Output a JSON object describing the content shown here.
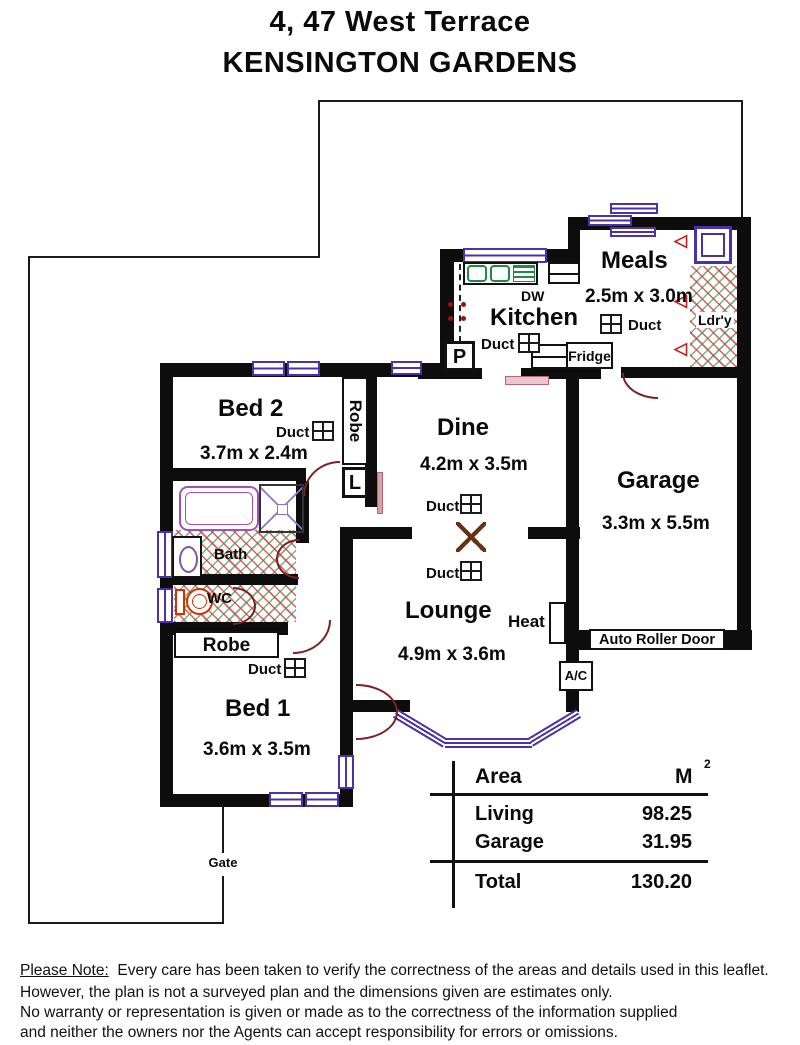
{
  "title": {
    "line1": "4, 47 West Terrace",
    "line2": "KENSINGTON GARDENS"
  },
  "rooms": {
    "bed2": {
      "name": "Bed 2",
      "dims": "3.7m x 2.4m"
    },
    "bed1": {
      "name": "Bed 1",
      "dims": "3.6m x 3.5m"
    },
    "dine": {
      "name": "Dine",
      "dims": "4.2m x 3.5m"
    },
    "lounge": {
      "name": "Lounge",
      "dims": "4.9m x 3.6m"
    },
    "kitchen": {
      "name": "Kitchen"
    },
    "meals": {
      "name": "Meals",
      "dims": "2.5m x 3.0m"
    },
    "garage": {
      "name": "Garage",
      "dims": "3.3m x 5.5m"
    },
    "laundry": {
      "name": "Ldr'y"
    },
    "bath": {
      "name": "Bath"
    },
    "wc": {
      "name": "WC"
    }
  },
  "labels": {
    "duct": "Duct",
    "dw": "DW",
    "fridge": "Fridge",
    "pantry": "P",
    "linen": "L",
    "robe": "Robe",
    "heat": "Heat",
    "ac": "A/C",
    "auto_roller_door": "Auto Roller Door",
    "gate": "Gate"
  },
  "area_table": {
    "header": {
      "col1": "Area",
      "col2": "M",
      "superscript": "2"
    },
    "rows": [
      {
        "label": "Living",
        "value": "98.25"
      },
      {
        "label": "Garage",
        "value": "31.95"
      }
    ],
    "total": {
      "label": "Total",
      "value": "130.20"
    }
  },
  "disclaimer": {
    "heading": "Please Note:",
    "line1": "Every care has been taken to verify the correctness of the areas and details used in this leaflet.",
    "line2": "However, the plan is not a surveyed plan and the dimensions given are estimates only.",
    "line3": "No warranty or representation is given or made as to the correctness of the information supplied",
    "line4": "and neither the owners nor the Agents can accept responsibility for errors or omissions."
  },
  "colors": {
    "wall": "#0d0d0d",
    "window": "#4b32a8",
    "door": "#7b2222",
    "hatch_red": "#cd4646",
    "hatch_green": "#5aa564",
    "fixture_purple": "#a050b8",
    "toilet_red": "#cc3300",
    "sink_green": "#228844"
  }
}
